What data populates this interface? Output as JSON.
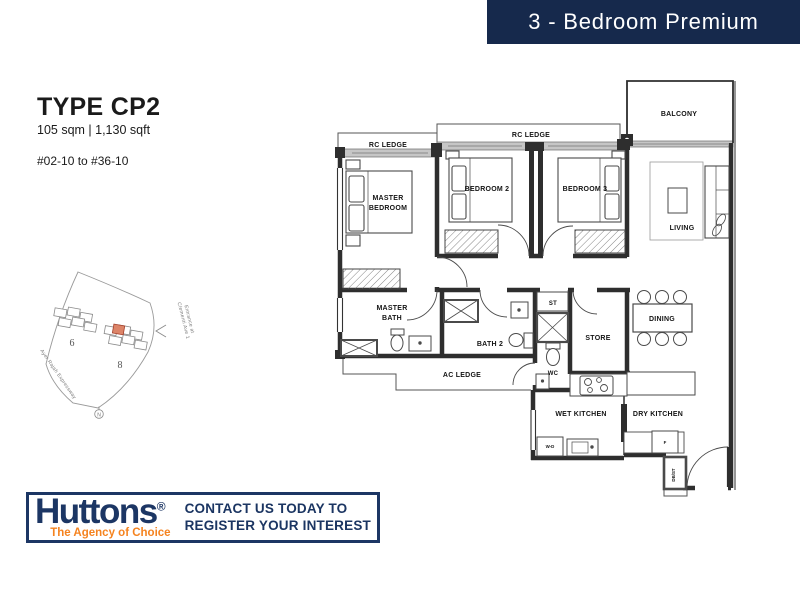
{
  "header": {
    "title": "3 - Bedroom Premium"
  },
  "unit": {
    "type": "TYPE CP2",
    "area": "105 sqm | 1,130 sqft",
    "stacks": "#02-10 to #36-10"
  },
  "floorplan": {
    "rooms": {
      "balcony": "BALCONY",
      "rc_ledge_left": "RC LEDGE",
      "rc_ledge_top": "RC LEDGE",
      "master_bedroom_line1": "MASTER",
      "master_bedroom_line2": "BEDROOM",
      "bedroom2": "BEDROOM 2",
      "bedroom3": "BEDROOM 3",
      "living": "LIVING",
      "master_bath_line1": "MASTER",
      "master_bath_line2": "BATH",
      "bath2": "BATH 2",
      "st": "ST",
      "store": "STORE",
      "wc": "WC",
      "dining": "DINING",
      "ac_ledge": "AC LEDGE",
      "wet_kitchen": "WET KITCHEN",
      "dry_kitchen": "DRY KITCHEN",
      "washer_dryer": "W-D",
      "fridge": "F",
      "db_st": "DB/ST"
    }
  },
  "sitemap": {
    "block_left": "6",
    "block_right": "8",
    "road": "Ayer Rajah Expressway",
    "entrance_line1": "Entrance at",
    "entrance_line2": "Clementi Ave 1",
    "north": "N"
  },
  "footer": {
    "brand": "Huttons",
    "registered": "®",
    "tagline": "The Agency of Choice",
    "cta_line1": "CONTACT US TODAY TO",
    "cta_line2": "REGISTER YOUR INTEREST"
  },
  "colors": {
    "header_bg": "#16294C",
    "brand_navy": "#1C3664",
    "brand_orange": "#F5831F",
    "wall": "#2E2E2E",
    "highlight_unit": "#DC8468"
  }
}
